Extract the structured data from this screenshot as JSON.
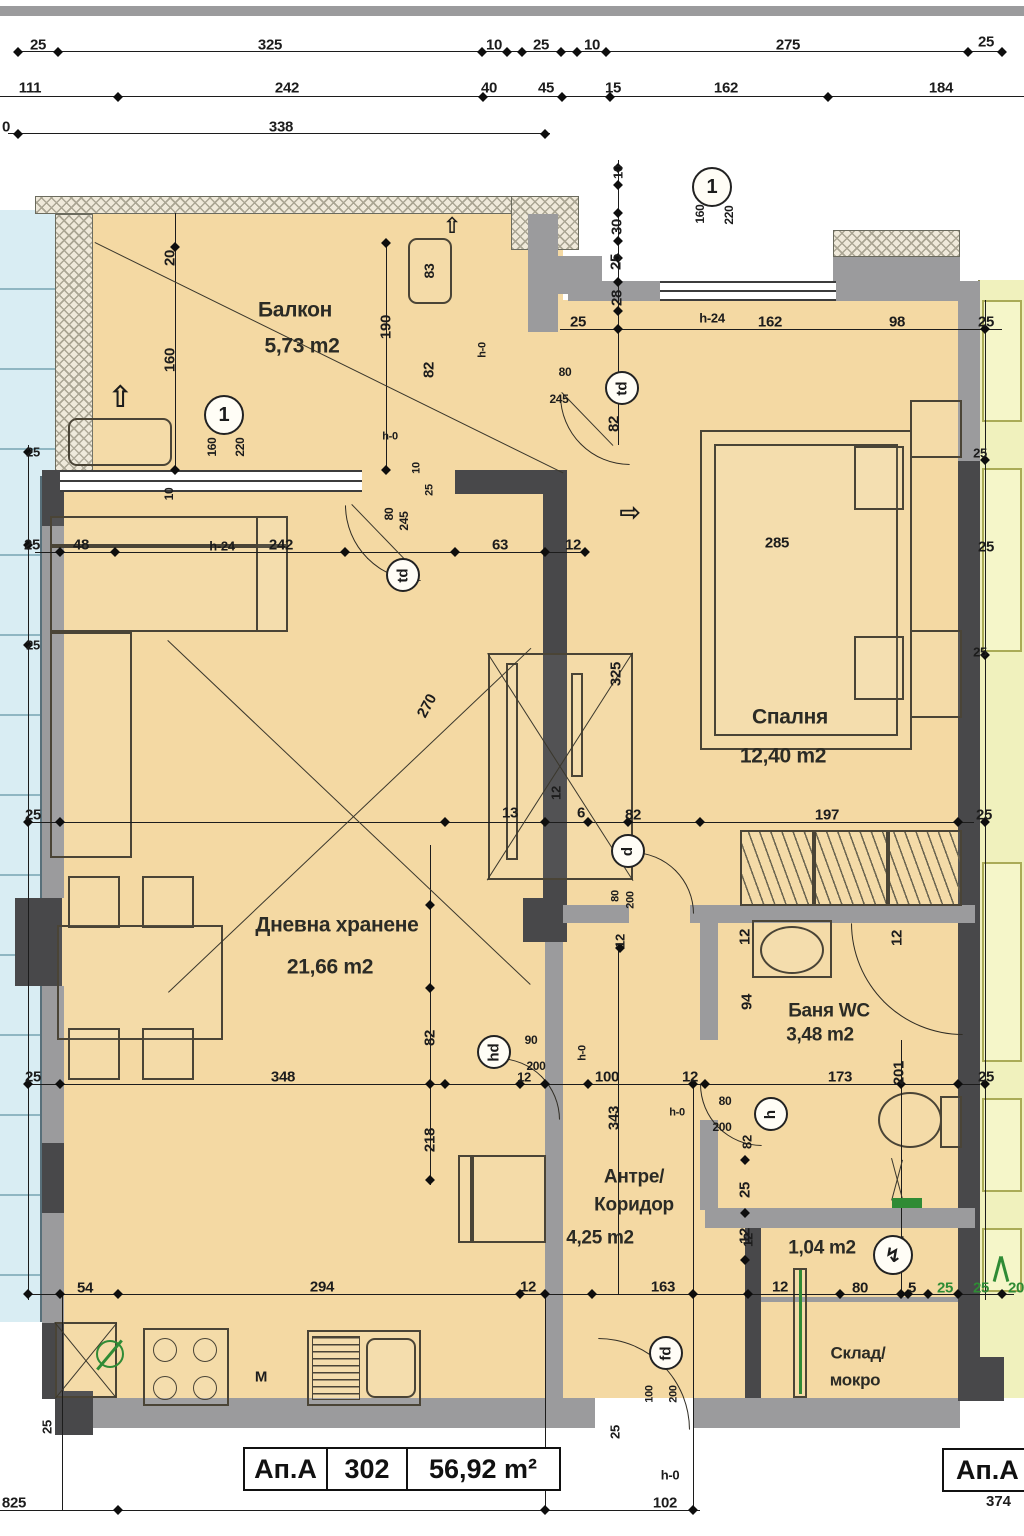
{
  "title_block": {
    "unit": "Ап.А",
    "number": "302",
    "area": "56,92 m²"
  },
  "corner_label": {
    "unit": "Ап.А",
    "dim": "374"
  },
  "rooms": [
    {
      "name": "Балкон",
      "area": "5,73 m2"
    },
    {
      "name": "Спалня",
      "area": "12,40 m2"
    },
    {
      "name": "Дневна хранене",
      "area": "21,66 m2"
    },
    {
      "name": "Баня WC",
      "area": "3,48 m2"
    },
    {
      "name": "Антре/Коридор",
      "area": "4,25 m2"
    },
    {
      "name": "Склад/мокро",
      "area": "1,04 m2"
    }
  ],
  "colors": {
    "floor": "#f4d9a3",
    "neighbor_left": "#d9edf3",
    "neighbor_right": "#f0f1bd",
    "wall_dark": "#48484a",
    "wall_gray": "#9b9b9d",
    "accent_green": "#2f8b35"
  },
  "labels": [
    {
      "t": "25",
      "x": 38,
      "y": 45
    },
    {
      "t": "325",
      "x": 270,
      "y": 45
    },
    {
      "t": "10",
      "x": 494,
      "y": 45
    },
    {
      "t": "25",
      "x": 541,
      "y": 45
    },
    {
      "t": "10",
      "x": 592,
      "y": 45
    },
    {
      "t": "275",
      "x": 788,
      "y": 45
    },
    {
      "t": "25",
      "x": 986,
      "y": 42
    },
    {
      "t": "111",
      "x": 30,
      "y": 88
    },
    {
      "t": "242",
      "x": 287,
      "y": 88
    },
    {
      "t": "40",
      "x": 489,
      "y": 88
    },
    {
      "t": "45",
      "x": 546,
      "y": 88
    },
    {
      "t": "15",
      "x": 613,
      "y": 88
    },
    {
      "t": "162",
      "x": 726,
      "y": 88
    },
    {
      "t": "184",
      "x": 941,
      "y": 88
    },
    {
      "t": "0",
      "x": 6,
      "y": 127
    },
    {
      "t": "338",
      "x": 281,
      "y": 127
    },
    {
      "t": "Балкон",
      "x": 295,
      "y": 310,
      "fs": 21,
      "c": "#2b2b25"
    },
    {
      "t": "5,73 m2",
      "x": 302,
      "y": 346,
      "fs": 21,
      "c": "#2b2b25"
    },
    {
      "t": "20",
      "x": 170,
      "y": 258,
      "r": -90
    },
    {
      "t": "160",
      "x": 170,
      "y": 360,
      "r": -90
    },
    {
      "t": "190",
      "x": 386,
      "y": 327,
      "r": -90
    },
    {
      "t": "82",
      "x": 429,
      "y": 370,
      "r": -90
    },
    {
      "t": "83",
      "x": 429,
      "y": 271,
      "r": -90,
      "fs": 14
    },
    {
      "t": "160",
      "x": 212,
      "y": 447,
      "r": -90,
      "fs": 12
    },
    {
      "t": "220",
      "x": 240,
      "y": 447,
      "r": -90,
      "fs": 12
    },
    {
      "t": "h-0",
      "x": 390,
      "y": 437,
      "fs": 11
    },
    {
      "t": "h-0",
      "x": 483,
      "y": 350,
      "r": -90,
      "fs": 11
    },
    {
      "t": "10",
      "x": 417,
      "y": 468,
      "r": -90,
      "fs": 11
    },
    {
      "t": "25",
      "x": 430,
      "y": 490,
      "r": -90,
      "fs": 11
    },
    {
      "t": "80",
      "x": 389,
      "y": 514,
      "r": -90,
      "fs": 12
    },
    {
      "t": "245",
      "x": 404,
      "y": 521,
      "r": -90,
      "fs": 12
    },
    {
      "t": "10",
      "x": 169,
      "y": 494,
      "r": -90,
      "fs": 12
    },
    {
      "t": "10",
      "x": 618,
      "y": 172,
      "r": -90,
      "fs": 13
    },
    {
      "t": "30",
      "x": 617,
      "y": 227,
      "r": -90
    },
    {
      "t": "25",
      "x": 616,
      "y": 262,
      "r": -90
    },
    {
      "t": "28",
      "x": 617,
      "y": 298,
      "r": -90
    },
    {
      "t": "25",
      "x": 578,
      "y": 322
    },
    {
      "t": "h-24",
      "x": 712,
      "y": 318,
      "fs": 13
    },
    {
      "t": "162",
      "x": 770,
      "y": 322
    },
    {
      "t": "98",
      "x": 897,
      "y": 322
    },
    {
      "t": "25",
      "x": 986,
      "y": 322
    },
    {
      "t": "160",
      "x": 700,
      "y": 214,
      "r": -90,
      "fs": 12
    },
    {
      "t": "220",
      "x": 729,
      "y": 215,
      "r": -90,
      "fs": 12
    },
    {
      "t": "80",
      "x": 565,
      "y": 372,
      "fs": 12
    },
    {
      "t": "245",
      "x": 559,
      "y": 399,
      "fs": 12
    },
    {
      "t": "82",
      "x": 614,
      "y": 424,
      "r": -90
    },
    {
      "t": "25",
      "x": 32,
      "y": 545
    },
    {
      "t": "48",
      "x": 81,
      "y": 545
    },
    {
      "t": "h-24",
      "x": 222,
      "y": 546,
      "fs": 13
    },
    {
      "t": "242",
      "x": 281,
      "y": 545
    },
    {
      "t": "63",
      "x": 500,
      "y": 545
    },
    {
      "t": "12",
      "x": 573,
      "y": 545
    },
    {
      "t": "285",
      "x": 777,
      "y": 543
    },
    {
      "t": "25",
      "x": 986,
      "y": 547
    },
    {
      "t": "Спалня",
      "x": 790,
      "y": 717,
      "fs": 21,
      "c": "#2b2b25"
    },
    {
      "t": "12,40 m2",
      "x": 783,
      "y": 756,
      "fs": 21,
      "c": "#2b2b25"
    },
    {
      "t": "325",
      "x": 616,
      "y": 674,
      "r": -90
    },
    {
      "t": "82",
      "x": 633,
      "y": 815
    },
    {
      "t": "197",
      "x": 827,
      "y": 815
    },
    {
      "t": "25",
      "x": 984,
      "y": 815
    },
    {
      "t": "270",
      "x": 427,
      "y": 706,
      "r": -62
    },
    {
      "t": "13",
      "x": 510,
      "y": 813
    },
    {
      "t": "12",
      "x": 556,
      "y": 793,
      "r": -90,
      "fs": 13
    },
    {
      "t": "6",
      "x": 581,
      "y": 813
    },
    {
      "t": "80",
      "x": 616,
      "y": 896,
      "r": -90,
      "fs": 11
    },
    {
      "t": "200",
      "x": 631,
      "y": 900,
      "r": -90,
      "fs": 11
    },
    {
      "t": "12",
      "x": 620,
      "y": 941,
      "r": -90,
      "fs": 13
    },
    {
      "t": "Дневна хранене",
      "x": 337,
      "y": 925,
      "fs": 21,
      "c": "#2b2b25"
    },
    {
      "t": "21,66 m2",
      "x": 330,
      "y": 967,
      "fs": 21,
      "c": "#2b2b25"
    },
    {
      "t": "25",
      "x": 33,
      "y": 1077
    },
    {
      "t": "348",
      "x": 283,
      "y": 1077
    },
    {
      "t": "82",
      "x": 430,
      "y": 1038,
      "r": -90
    },
    {
      "t": "218",
      "x": 430,
      "y": 1140,
      "r": -90
    },
    {
      "t": "25",
      "x": 33,
      "y": 815
    },
    {
      "t": "25",
      "x": 33,
      "y": 452,
      "fs": 13
    },
    {
      "t": "25",
      "x": 33,
      "y": 645,
      "fs": 13
    },
    {
      "t": "25",
      "x": 980,
      "y": 453,
      "fs": 13
    },
    {
      "t": "25",
      "x": 980,
      "y": 652,
      "fs": 13
    },
    {
      "t": "90",
      "x": 531,
      "y": 1040,
      "fs": 12
    },
    {
      "t": "200",
      "x": 536,
      "y": 1066,
      "fs": 12
    },
    {
      "t": "h-0",
      "x": 583,
      "y": 1053,
      "r": -90,
      "fs": 11
    },
    {
      "t": "12",
      "x": 524,
      "y": 1077,
      "fs": 13
    },
    {
      "t": "12",
      "x": 745,
      "y": 937,
      "r": -90
    },
    {
      "t": "94",
      "x": 747,
      "y": 1002,
      "r": -90
    },
    {
      "t": "Баня WC",
      "x": 829,
      "y": 1011,
      "fs": 19,
      "c": "#2b2b25"
    },
    {
      "t": "3,48 m2",
      "x": 820,
      "y": 1035,
      "fs": 19,
      "c": "#2b2b25"
    },
    {
      "t": "12",
      "x": 897,
      "y": 938,
      "r": -90
    },
    {
      "t": "100",
      "x": 607,
      "y": 1077
    },
    {
      "t": "12",
      "x": 690,
      "y": 1077
    },
    {
      "t": "173",
      "x": 840,
      "y": 1077
    },
    {
      "t": "201",
      "x": 899,
      "y": 1073,
      "r": -90
    },
    {
      "t": "25",
      "x": 986,
      "y": 1077
    },
    {
      "t": "h-0",
      "x": 677,
      "y": 1113,
      "fs": 11
    },
    {
      "t": "80",
      "x": 725,
      "y": 1101,
      "fs": 12
    },
    {
      "t": "200",
      "x": 722,
      "y": 1127,
      "fs": 12
    },
    {
      "t": "82",
      "x": 747,
      "y": 1142,
      "r": -90,
      "fs": 13
    },
    {
      "t": "25",
      "x": 745,
      "y": 1190,
      "r": -90
    },
    {
      "t": "12",
      "x": 745,
      "y": 1236,
      "r": -90
    },
    {
      "t": "343",
      "x": 614,
      "y": 1118,
      "r": -90
    },
    {
      "t": "Антре/",
      "x": 634,
      "y": 1177,
      "fs": 19,
      "c": "#2b2b25"
    },
    {
      "t": "Коридор",
      "x": 634,
      "y": 1205,
      "fs": 19,
      "c": "#2b2b25"
    },
    {
      "t": "4,25 m2",
      "x": 600,
      "y": 1238,
      "fs": 19,
      "c": "#2b2b25"
    },
    {
      "t": "12",
      "x": 528,
      "y": 1287
    },
    {
      "t": "163",
      "x": 663,
      "y": 1287
    },
    {
      "t": "12",
      "x": 780,
      "y": 1287
    },
    {
      "t": "1,04 m2",
      "x": 822,
      "y": 1248,
      "fs": 19,
      "c": "#2b2b25"
    },
    {
      "t": "Склад/",
      "x": 858,
      "y": 1353,
      "fs": 17,
      "c": "#2b2b25"
    },
    {
      "t": "мокро",
      "x": 855,
      "y": 1380,
      "fs": 17,
      "c": "#2b2b25"
    },
    {
      "t": "12",
      "x": 748,
      "y": 1240,
      "r": -90,
      "fs": 13
    },
    {
      "t": "80",
      "x": 860,
      "y": 1288
    },
    {
      "t": "5",
      "x": 912,
      "y": 1288
    },
    {
      "t": "25",
      "x": 945,
      "y": 1288,
      "c": "#2f8b35"
    },
    {
      "t": "25",
      "x": 981,
      "y": 1288,
      "c": "#2f8b35"
    },
    {
      "t": "20",
      "x": 1016,
      "y": 1288,
      "c": "#2f8b35"
    },
    {
      "t": "12",
      "x": 899,
      "y": 1243,
      "r": -90,
      "fs": 13
    },
    {
      "t": "54",
      "x": 85,
      "y": 1288
    },
    {
      "t": "294",
      "x": 322,
      "y": 1287
    },
    {
      "t": "М",
      "x": 261,
      "y": 1377,
      "fs": 15
    },
    {
      "t": "25",
      "x": 47,
      "y": 1427,
      "r": -90,
      "fs": 13
    },
    {
      "t": "25",
      "x": 615,
      "y": 1432,
      "r": -90,
      "fs": 13
    },
    {
      "t": "100",
      "x": 650,
      "y": 1394,
      "r": -90,
      "fs": 11
    },
    {
      "t": "200",
      "x": 674,
      "y": 1394,
      "r": -90,
      "fs": 11
    },
    {
      "t": "h-0",
      "x": 670,
      "y": 1475,
      "fs": 13
    },
    {
      "t": "102",
      "x": 665,
      "y": 1503
    },
    {
      "t": "825",
      "x": 14,
      "y": 1503
    },
    {
      "t": "⇧",
      "x": 120,
      "y": 398,
      "fs": 30
    },
    {
      "t": "⇧",
      "x": 452,
      "y": 226,
      "fs": 22
    },
    {
      "t": "⇨",
      "x": 630,
      "y": 512,
      "fs": 26
    }
  ],
  "tags": [
    {
      "t": "1",
      "x": 224,
      "y": 415,
      "d": 40
    },
    {
      "t": "1",
      "x": 712,
      "y": 187,
      "d": 40
    },
    {
      "t": "td",
      "x": 622,
      "y": 388,
      "d": 34,
      "r": -90
    },
    {
      "t": "td",
      "x": 403,
      "y": 575,
      "d": 34,
      "r": -90
    },
    {
      "t": "d",
      "x": 628,
      "y": 851,
      "d": 34,
      "r": -90
    },
    {
      "t": "hd",
      "x": 494,
      "y": 1052,
      "d": 34,
      "r": -90
    },
    {
      "t": "h",
      "x": 771,
      "y": 1114,
      "d": 34,
      "r": -90
    },
    {
      "t": "fd",
      "x": 666,
      "y": 1353,
      "d": 34,
      "r": -90
    },
    {
      "t": "↯",
      "x": 893,
      "y": 1255,
      "d": 40
    }
  ]
}
